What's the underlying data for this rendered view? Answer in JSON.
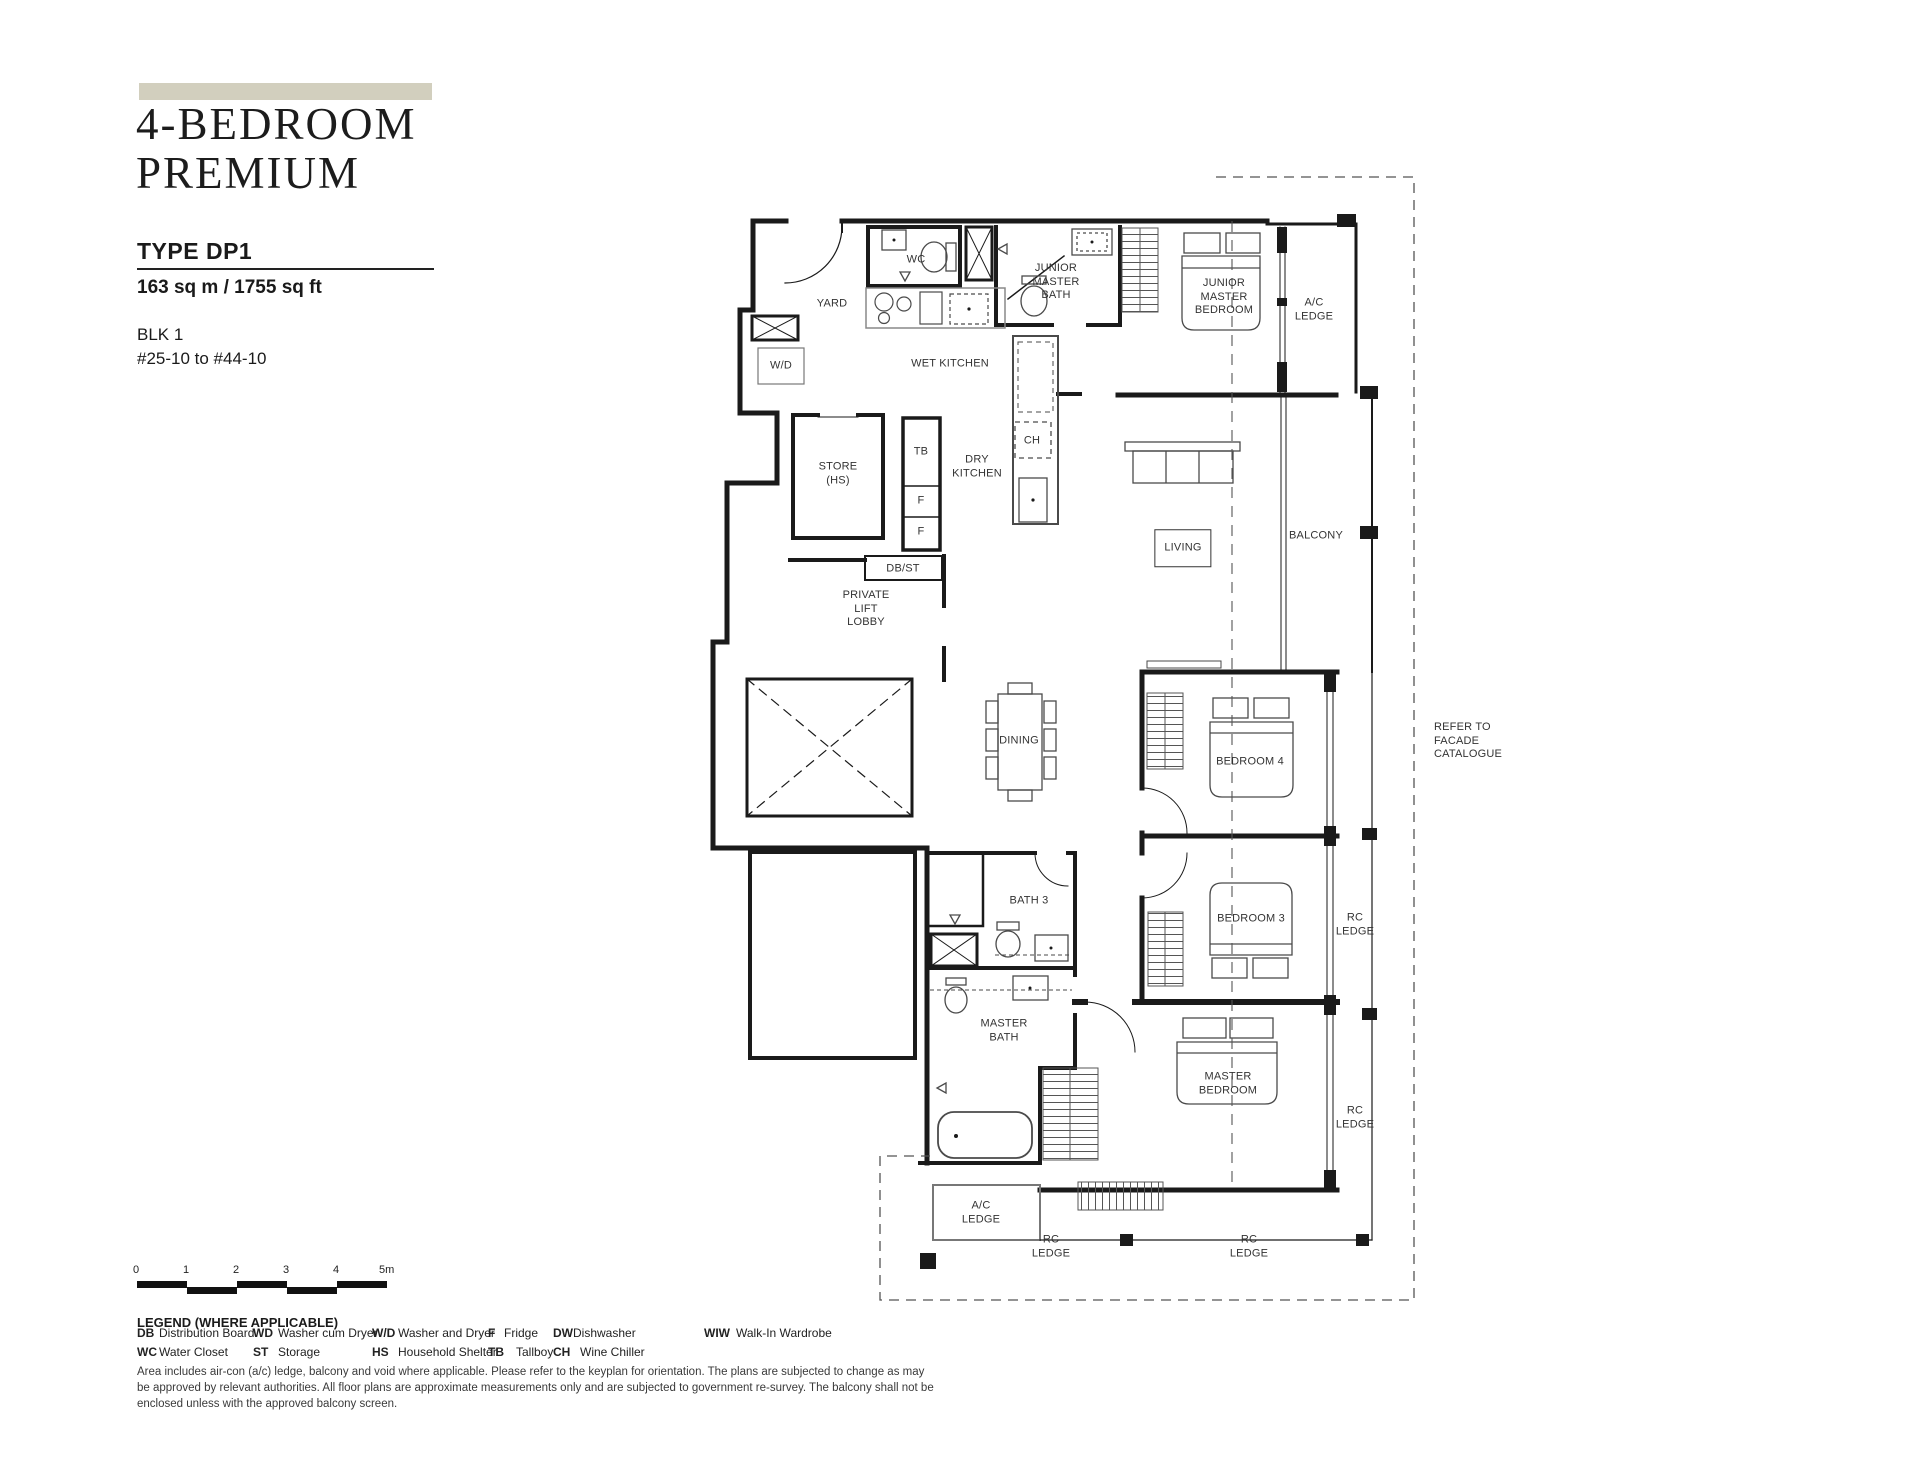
{
  "header": {
    "category": "4-BEDROOM\nPREMIUM",
    "type_label": "TYPE DP1",
    "area": "163 sq m / 1755 sq ft",
    "block": "BLK 1",
    "unit_range": "#25-10 to #44-10"
  },
  "colors": {
    "accent_bar": "#d2cfbe",
    "ink": "#1a1a1a"
  },
  "plan": {
    "labels": [
      {
        "id": "yard",
        "text": "YARD",
        "x": 832,
        "y": 304
      },
      {
        "id": "wc",
        "text": "WC",
        "x": 916,
        "y": 260
      },
      {
        "id": "junior-master-bath",
        "text": "JUNIOR\nMASTER\nBATH",
        "x": 1056,
        "y": 282
      },
      {
        "id": "junior-master-bedroom",
        "text": "JUNIOR\nMASTER\nBEDROOM",
        "x": 1224,
        "y": 297
      },
      {
        "id": "ac-ledge-top",
        "text": "A/C\nLEDGE",
        "x": 1314,
        "y": 310
      },
      {
        "id": "washer-dryer",
        "text": "W/D",
        "x": 781,
        "y": 366
      },
      {
        "id": "wet-kitchen",
        "text": "WET KITCHEN",
        "x": 950,
        "y": 364
      },
      {
        "id": "store-hs",
        "text": "STORE\n(HS)",
        "x": 838,
        "y": 474
      },
      {
        "id": "tallboy",
        "text": "TB",
        "x": 921,
        "y": 452
      },
      {
        "id": "fridge-1",
        "text": "F",
        "x": 921,
        "y": 501
      },
      {
        "id": "fridge-2",
        "text": "F",
        "x": 921,
        "y": 532
      },
      {
        "id": "dry-kitchen",
        "text": "DRY\nKITCHEN",
        "x": 977,
        "y": 467
      },
      {
        "id": "wine-chiller",
        "text": "CH",
        "x": 1032,
        "y": 441
      },
      {
        "id": "db-st",
        "text": "DB/ST",
        "x": 903,
        "y": 569
      },
      {
        "id": "private-lift-lobby",
        "text": "PRIVATE\nLIFT\nLOBBY",
        "x": 866,
        "y": 609
      },
      {
        "id": "living",
        "text": "LIVING",
        "x": 1183,
        "y": 548,
        "boxed": true
      },
      {
        "id": "balcony",
        "text": "BALCONY",
        "x": 1316,
        "y": 536
      },
      {
        "id": "dining",
        "text": "DINING",
        "x": 1019,
        "y": 741
      },
      {
        "id": "bedroom-4",
        "text": "BEDROOM 4",
        "x": 1250,
        "y": 762
      },
      {
        "id": "bath-3",
        "text": "BATH 3",
        "x": 1029,
        "y": 901
      },
      {
        "id": "bedroom-3",
        "text": "BEDROOM 3",
        "x": 1251,
        "y": 919
      },
      {
        "id": "rc-ledge-right-1",
        "text": "RC\nLEDGE",
        "x": 1355,
        "y": 925
      },
      {
        "id": "master-bath",
        "text": "MASTER\nBATH",
        "x": 1004,
        "y": 1031
      },
      {
        "id": "master-bedroom",
        "text": "MASTER\nBEDROOM",
        "x": 1228,
        "y": 1084
      },
      {
        "id": "rc-ledge-right-2",
        "text": "RC\nLEDGE",
        "x": 1355,
        "y": 1118
      },
      {
        "id": "ac-ledge-bottom",
        "text": "A/C\nLEDGE",
        "x": 981,
        "y": 1213
      },
      {
        "id": "rc-ledge-bottom-1",
        "text": "RC\nLEDGE",
        "x": 1051,
        "y": 1247
      },
      {
        "id": "rc-ledge-bottom-2",
        "text": "RC\nLEDGE",
        "x": 1249,
        "y": 1247
      },
      {
        "id": "refer-facade",
        "text": "REFER TO\nFACADE\nCATALOGUE",
        "x": 1434,
        "y": 741,
        "align": "left"
      }
    ]
  },
  "scale_bar": {
    "ticks": [
      "0",
      "1",
      "2",
      "3",
      "4",
      "5m"
    ]
  },
  "legend": {
    "title": "LEGEND (WHERE APPLICABLE)",
    "row1": [
      {
        "abbr": "DB",
        "term": "Distribution Board"
      },
      {
        "abbr": "WD",
        "term": "Washer cum Dryer"
      },
      {
        "abbr": "W/D",
        "term": "Washer and Dryer"
      },
      {
        "abbr": "F",
        "term": "Fridge"
      },
      {
        "abbr": "DW",
        "term": "Dishwasher"
      },
      {
        "abbr": "WIW",
        "term": "Walk-In Wardrobe"
      }
    ],
    "row2": [
      {
        "abbr": "WC",
        "term": "Water Closet"
      },
      {
        "abbr": "ST",
        "term": "Storage"
      },
      {
        "abbr": "HS",
        "term": "Household Shelter"
      },
      {
        "abbr": "TB",
        "term": "Tallboy"
      },
      {
        "abbr": "CH",
        "term": "Wine Chiller"
      }
    ]
  },
  "disclaimer": "Area includes air-con (a/c) ledge, balcony and void where applicable. Please refer to the keyplan for orientation. The plans are subjected to change as may\nbe approved by relevant authorities. All floor plans are approximate measurements only and are subjected to government re-survey. The balcony shall not be\nenclosed unless with the approved balcony screen."
}
